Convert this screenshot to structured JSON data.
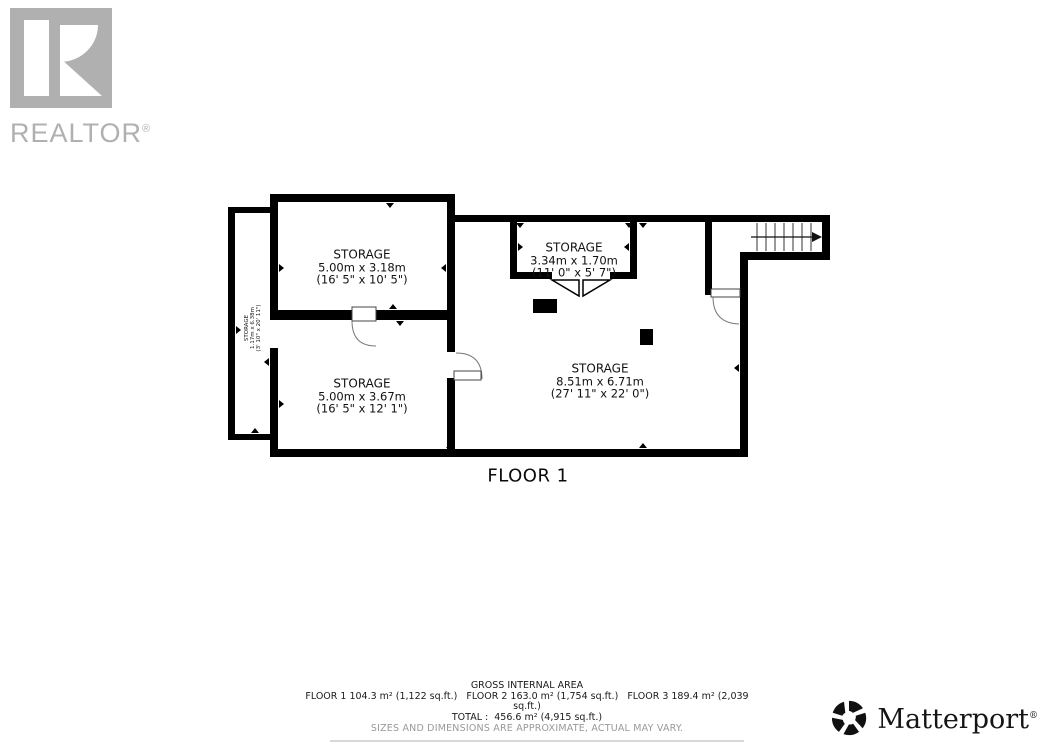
{
  "branding": {
    "realtor_label": "REALTOR",
    "registered_mark": "®",
    "matterport_label": "Matterport",
    "icons": {
      "realtor_mark": "block-R-logo",
      "matterport_mark": "pinwheel-logo",
      "stairs_arrow": "→"
    },
    "colors": {
      "wall_black": "#000000",
      "realtor_gray": "#b0b0b0",
      "disclaimer_gray": "#999999"
    }
  },
  "floor_plan": {
    "floor_label": "FLOOR 1",
    "rooms": [
      {
        "name": "STORAGE",
        "metric": "5.00m x 3.18m",
        "imperial": "(16' 5\" x 10' 5\")"
      },
      {
        "name": "STORAGE",
        "metric": "3.34m x 1.70m",
        "imperial": "(11' 0\" x 5' 7\")"
      },
      {
        "name": "STORAGE",
        "metric": "5.00m x 3.67m",
        "imperial": "(16' 5\" x 12' 1\")"
      },
      {
        "name": "STORAGE",
        "metric": "8.51m x 6.71m",
        "imperial": "(27' 11\" x 22' 0\")"
      },
      {
        "name": "STORAGE",
        "metric": "1.17m x 6.38m",
        "imperial": "(3' 10\" x 20' 11\")"
      }
    ]
  },
  "summary": {
    "title": "GROSS INTERNAL AREA",
    "line1": "FLOOR 1 104.3 m² (1,122 sq.ft.)   FLOOR 2 163.0 m² (1,754 sq.ft.)   FLOOR 3 189.4 m² (2,039",
    "line2": "sq.ft.)",
    "total": "TOTAL :  456.6 m² (4,915 sq.ft.)",
    "disclaimer": "SIZES AND DIMENSIONS ARE APPROXIMATE, ACTUAL MAY VARY."
  }
}
